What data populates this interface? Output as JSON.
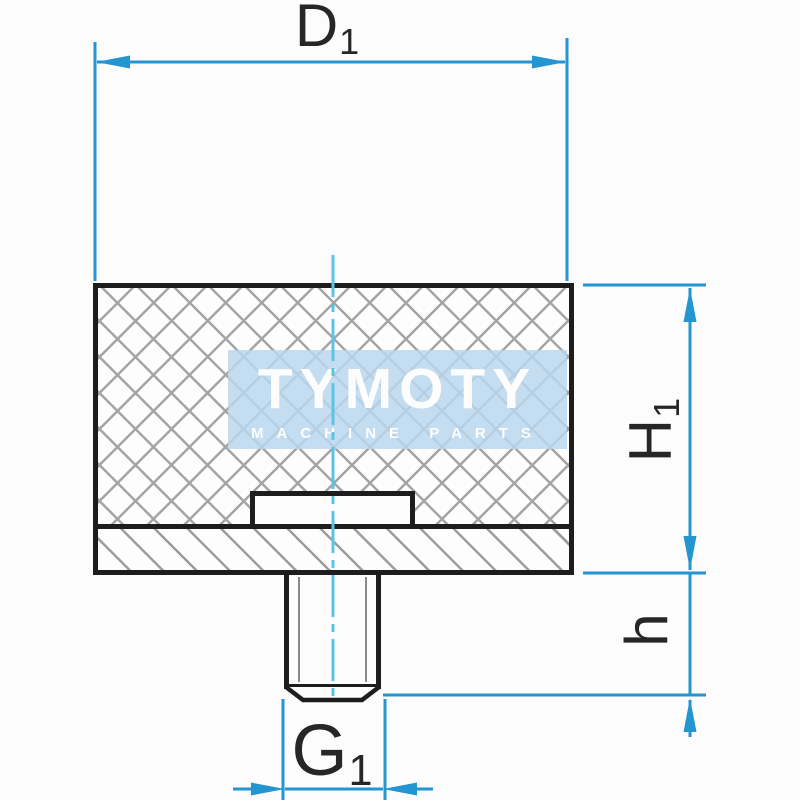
{
  "drawing": {
    "kind": "technical-drawing",
    "part": "rubber-buffer-with-threaded-stud",
    "dimensions": {
      "d1": {
        "base": "D",
        "sub": "1"
      },
      "h1": {
        "base": "H",
        "sub": "1"
      },
      "h": {
        "base": "h",
        "sub": ""
      },
      "g1": {
        "base": "G",
        "sub": "1"
      }
    },
    "colors": {
      "dimension_blue": "#2395d0",
      "centerline_cyan": "#5ac4e8",
      "outline_black": "#1d1d1d",
      "hatch_gray": "#a5a5a5",
      "watermark_bg": "#b9d7ed",
      "watermark_text": "#fdfdfd",
      "label_text": "#262626",
      "background": "#fcfcfc"
    }
  },
  "watermark": {
    "brand": "TYMOTY",
    "tagline": "MACHINE PARTS"
  }
}
